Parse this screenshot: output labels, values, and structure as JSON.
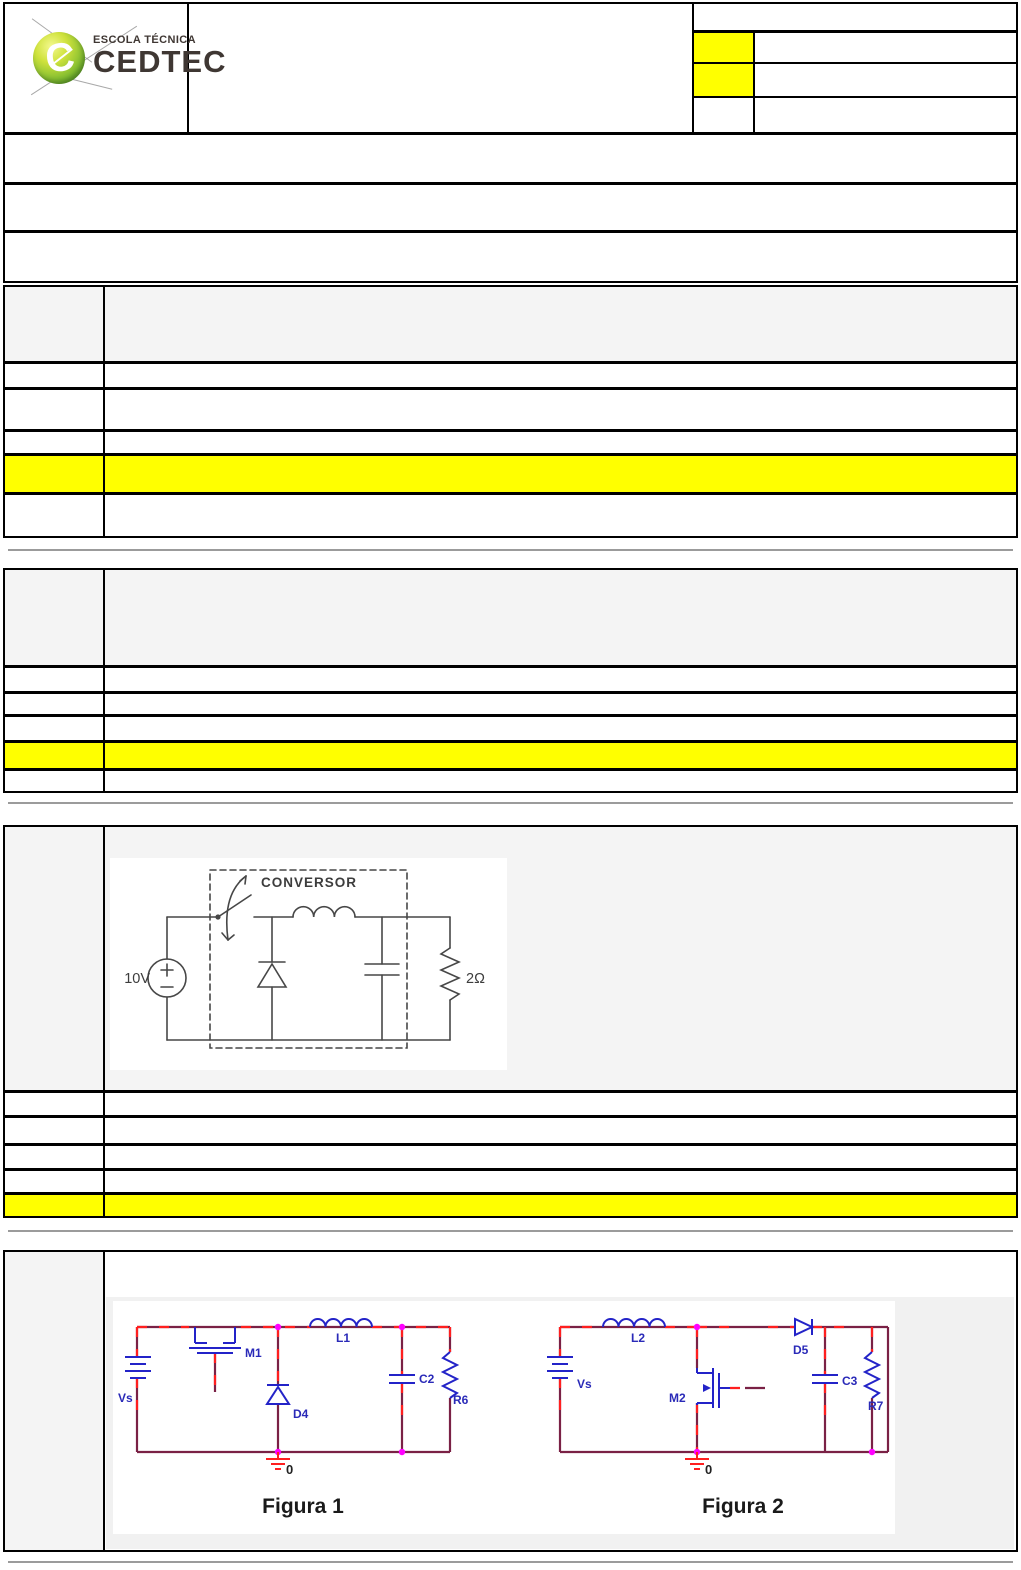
{
  "logo": {
    "school_type": "ESCOLA TÉCNICA",
    "school_name": "CEDTEC",
    "emblem_letter": "C"
  },
  "header": {
    "title_cell": "",
    "right_table": {
      "row1": "",
      "rows": [
        {
          "key": "",
          "value": "",
          "key_highlighted": true
        },
        {
          "key": "",
          "value": "",
          "key_highlighted": true
        },
        {
          "key": "",
          "value": "",
          "key_highlighted": false
        }
      ]
    },
    "band_rows": [
      "",
      "",
      ""
    ]
  },
  "questions": [
    {
      "number": "",
      "stem": "",
      "options": [
        {
          "text": "",
          "highlighted": false
        },
        {
          "text": "",
          "highlighted": false
        },
        {
          "text": "",
          "highlighted": false
        },
        {
          "text": "",
          "highlighted": true
        },
        {
          "text": "",
          "highlighted": false
        }
      ]
    },
    {
      "number": "",
      "stem": "",
      "options": [
        {
          "text": "",
          "highlighted": false
        },
        {
          "text": "",
          "highlighted": false
        },
        {
          "text": "",
          "highlighted": false
        },
        {
          "text": "",
          "highlighted": true
        },
        {
          "text": "",
          "highlighted": false
        }
      ]
    },
    {
      "number": "",
      "stem": "",
      "options": [
        {
          "text": "",
          "highlighted": false
        },
        {
          "text": "",
          "highlighted": false
        },
        {
          "text": "",
          "highlighted": false
        },
        {
          "text": "",
          "highlighted": false
        },
        {
          "text": "",
          "highlighted": true
        }
      ]
    },
    {
      "number": "",
      "stem": ""
    }
  ],
  "circuit1": {
    "box_label": "CONVERSOR",
    "source_voltage": "10V",
    "load_resistance": "2Ω"
  },
  "figura1": {
    "source": "Vs",
    "transistor": "M1",
    "inductor": "L1",
    "diode": "D4",
    "capacitor": "C2",
    "resistor": "R6",
    "ground_node": "0",
    "caption": "Figura 1"
  },
  "figura2": {
    "source": "Vs",
    "inductor": "L2",
    "transistor": "M2",
    "diode": "D5",
    "capacitor": "C3",
    "resistor": "R7",
    "ground_node": "0",
    "caption": "Figura 2"
  },
  "colors": {
    "highlight": "#ffff00",
    "stem_background": "#f4f4f4",
    "table_border": "#000000",
    "divider": "#9b9b9b",
    "wire": "#7a2145",
    "wire_dash": "#ff1f1f",
    "component": "#2323c8",
    "junction": "#ff00ff",
    "ground": "#ff1f1f"
  }
}
